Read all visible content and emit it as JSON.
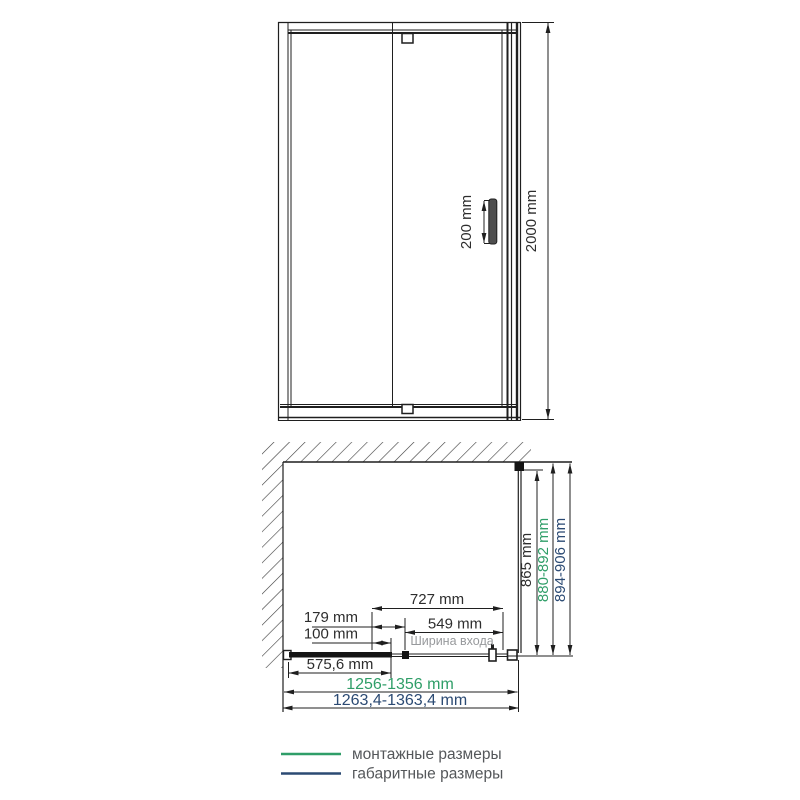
{
  "drawing": {
    "front_view": {
      "handle_length": "200 mm",
      "total_height": "2000 mm"
    },
    "plan_view": {
      "side_panel_glass": "865 mm",
      "side_mounting": "880-892 mm",
      "side_overall": "894-906 mm",
      "door_assembly": "727 mm",
      "hinge_offset": "179 mm",
      "pivot_offset": "100 mm",
      "entry_width_value": "549 mm",
      "entry_width_caption": "Ширина входа",
      "fixed_panel": "575,6 mm",
      "width_mounting": "1256-1356 mm",
      "width_overall": "1263,4-1363,4 mm"
    },
    "legend": {
      "items": [
        {
          "label": "монтажные размеры",
          "color": "#2f9e68"
        },
        {
          "label": "габаритные размеры",
          "color": "#2b4a73"
        }
      ]
    },
    "colors": {
      "drawing_line": "#1f1f1f",
      "dimension_text": "#2d2d2d",
      "mounting_green": "#2f9e68",
      "overall_navy": "#2b4a73",
      "caption_gray": "#97999c",
      "legend_text": "#54575a"
    }
  }
}
